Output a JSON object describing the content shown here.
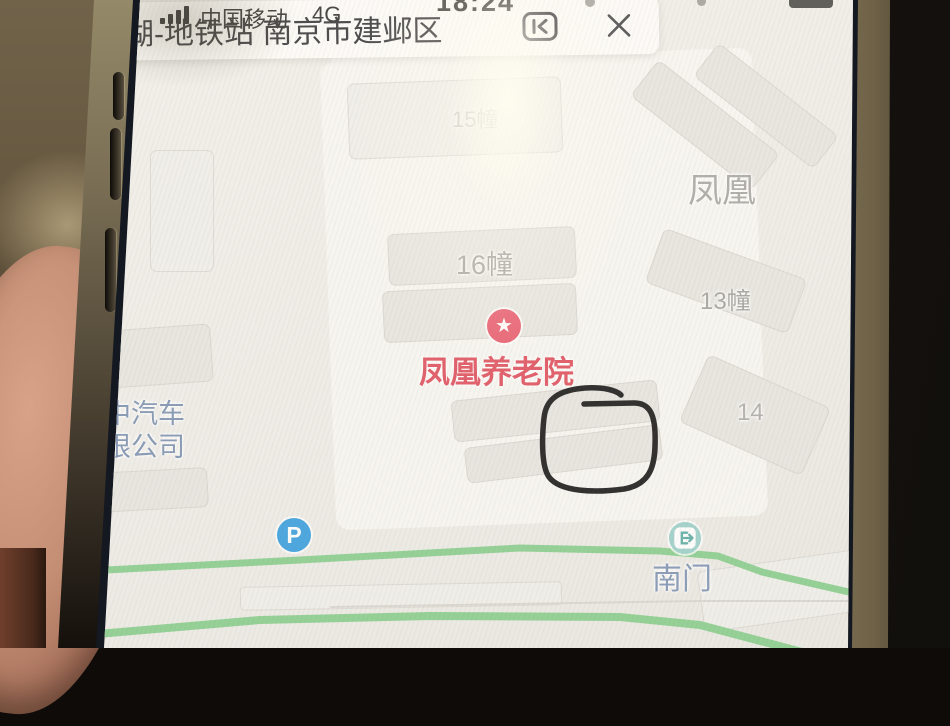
{
  "status_bar": {
    "carrier": "中国移动",
    "network": "4G",
    "time": "18:24"
  },
  "search_bar": {
    "query": "莫愁湖-地铁站 南京市建邺区"
  },
  "sidebar": {
    "items": [
      {
        "label": "图层",
        "icon": "layers-icon",
        "badge": true
      },
      {
        "label": "旅游",
        "icon": "travel-icon",
        "badge": false
      },
      {
        "label": "上报",
        "icon": "report-icon",
        "badge": false
      },
      {
        "label": "打车",
        "icon": "taxi-icon",
        "badge": true
      },
      {
        "label": "语音定制",
        "icon": "voice-icon",
        "badge": true
      }
    ]
  },
  "map": {
    "labels": {
      "north_gate": "北门",
      "south_gate": "南门",
      "building_11": "11幢",
      "building_15": "15幢",
      "building_16": "16幢",
      "building_13": "13幢",
      "building_14": "14",
      "area_name": "凤凰",
      "poi_name": "凤凰养老院",
      "company_line1": "中汽车",
      "company_line2": "限公司"
    },
    "icons": {
      "parking": "P",
      "poi_star": "★"
    },
    "colors": {
      "road_green": "#8bce90",
      "poi_red": "#e8566a",
      "label_gray": "#a3a29e",
      "label_blue": "#8296b5",
      "parking_blue": "#3ba0df",
      "gate_teal": "#9ed0cb"
    }
  },
  "annotation": {
    "type": "hand-drawn-circle",
    "color": "#1b1b1b"
  }
}
